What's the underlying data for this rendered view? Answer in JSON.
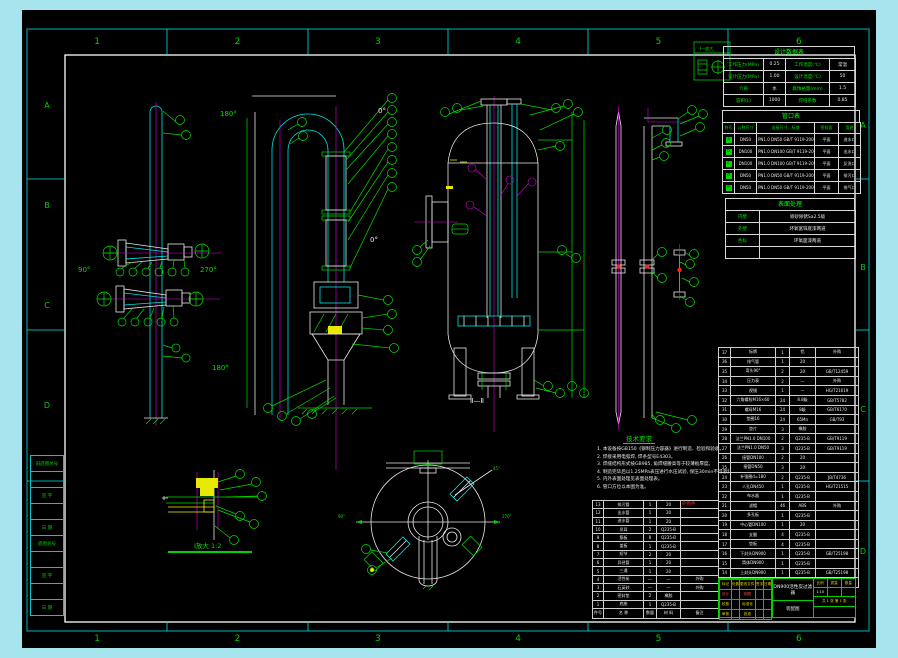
{
  "frame": {
    "zones_h": [
      "1",
      "2",
      "3",
      "4",
      "5",
      "6"
    ],
    "zones_v": [
      "A",
      "B",
      "C",
      "D"
    ]
  },
  "labels": {
    "v1_left": "90°",
    "v1_right": "270°",
    "v2_top": "180°",
    "v2_bottom": "180°",
    "v2_zero_top": "0°",
    "v2_zero_mid": "0°",
    "section": "Ⅱ—Ⅱ",
    "detail_caption": "Ⅰ放大 1:2",
    "legend_title": "Ⅰ—放大",
    "plan_45": "45°",
    "plan_left": "90°",
    "plan_right": "270°"
  },
  "design_table": {
    "title": "设计数据表",
    "rows": [
      [
        "工作压力(MPa)",
        "0.25",
        "工作温度(℃)",
        "常温"
      ],
      [
        "设计压力(MPa)",
        "1.00",
        "设计温度(℃)",
        "50"
      ],
      [
        "介质",
        "水",
        "腐蚀裕量(mm)",
        "1.5"
      ],
      [
        "容积(L)",
        "1000",
        "焊缝系数",
        "0.85"
      ]
    ]
  },
  "nozzle_table": {
    "title": "管口表",
    "header": [
      "符号",
      "公称尺寸",
      "连接尺寸、标准",
      "密封面",
      "用途"
    ],
    "rows": [
      [
        "a",
        "DN50",
        "PN1.0 DN50 GB/T 9119-2000",
        "平面",
        "进水口"
      ],
      [
        "b",
        "DN100",
        "PN1.0 DN100 GB/T 9119-2000",
        "平面",
        "出水口"
      ],
      [
        "c",
        "DN100",
        "PN1.0 DN100 GB/T 9119-2000",
        "平面",
        "反洗口"
      ],
      [
        "d",
        "DN50",
        "PN1.0 DN50 GB/T 9119-2000",
        "平面",
        "排污口"
      ],
      [
        "e",
        "DN50",
        "PN1.0 DN50 GB/T 9119-2000",
        "平面",
        "排气口"
      ]
    ]
  },
  "surface_table": {
    "title": "表面处理",
    "rows": [
      [
        "内壁",
        "喷砂除锈Sa2.5级"
      ],
      [
        "外壁",
        "环氧富锌底漆两道"
      ],
      [
        "色标",
        "环氧面漆两道"
      ],
      [
        "",
        ""
      ]
    ]
  },
  "notes": {
    "title": "技术要求",
    "lines": [
      "1. 本设备按GB150《钢制压力容器》进行制造、检验和验收。",
      "2. 焊接采用电弧焊, 焊条型号E4303。",
      "3. 焊缝结构形式按GB985, 角焊缝腰高等于较薄板厚度。",
      "4. 制造完毕后以1.25MPa表压进行水压试验, 保压30min不得渗漏。",
      "5. 内外表面处理见表面处理表。",
      "6. 管口方位以本图为准。"
    ]
  },
  "bom_right": {
    "header": [
      "件号",
      "名  称",
      "数量",
      "材 料",
      "备  注"
    ],
    "rows": [
      [
        "37",
        "标牌",
        "1",
        "铝",
        "外购"
      ],
      [
        "36",
        "排气管",
        "1",
        "20",
        ""
      ],
      [
        "35",
        "弯头90°",
        "2",
        "20",
        "GB/T12459"
      ],
      [
        "34",
        "压力表",
        "2",
        "—",
        "外购"
      ],
      [
        "33",
        "视镜",
        "1",
        "—",
        "HG/T21619"
      ],
      [
        "32",
        "六角螺栓M16×60",
        "24",
        "8.8级",
        "GB/T5782"
      ],
      [
        "31",
        "螺母M16",
        "24",
        "8级",
        "GB/T6170"
      ],
      [
        "30",
        "垫圈16",
        "24",
        "65Mn",
        "GB/T93"
      ],
      [
        "29",
        "垫片",
        "3",
        "橡胶",
        ""
      ],
      [
        "28",
        "法兰PN1.0 DN100",
        "2",
        "Q235-B",
        "GB/T9119"
      ],
      [
        "27",
        "法兰PN1.0 DN50",
        "3",
        "Q235-B",
        "GB/T9119"
      ],
      [
        "26",
        "接管DN100",
        "2",
        "20",
        ""
      ],
      [
        "25",
        "接管DN50",
        "3",
        "20",
        ""
      ],
      [
        "24",
        "补强圈d=180",
        "2",
        "Q235-B",
        "JB/T4736"
      ],
      [
        "23",
        "人孔DN450",
        "1",
        "Q235-B",
        "HG/T21515"
      ],
      [
        "22",
        "布水器",
        "1",
        "Q235-B",
        ""
      ],
      [
        "21",
        "滤帽",
        "46",
        "ABS",
        "外购"
      ],
      [
        "20",
        "多孔板",
        "1",
        "Q235-B",
        ""
      ],
      [
        "19",
        "中心管DN100",
        "1",
        "20",
        ""
      ],
      [
        "18",
        "支腿",
        "4",
        "Q235-B",
        ""
      ],
      [
        "17",
        "垫板",
        "4",
        "Q235-B",
        ""
      ],
      [
        "16",
        "下封头DN900",
        "1",
        "Q235-B",
        "GB/T25198"
      ],
      [
        "15",
        "筒体DN900",
        "1",
        "Q235-B",
        ""
      ],
      [
        "14",
        "上封头DN900",
        "1",
        "Q235-B",
        "GB/T25198"
      ]
    ]
  },
  "bom_bottom": {
    "red_note": "外购件",
    "header": [
      "件号",
      "名  称",
      "数量",
      "材 料",
      "备注"
    ],
    "rows": [
      [
        "13",
        "排污管",
        "1",
        "20",
        ""
      ],
      [
        "12",
        "出水管",
        "1",
        "20",
        ""
      ],
      [
        "11",
        "进水管",
        "1",
        "20",
        ""
      ],
      [
        "10",
        "吊耳",
        "2",
        "Q235-B",
        ""
      ],
      [
        "9",
        "筋板",
        "8",
        "Q235-B",
        ""
      ],
      [
        "8",
        "盖板",
        "1",
        "Q235-B",
        ""
      ],
      [
        "7",
        "短节",
        "2",
        "20",
        ""
      ],
      [
        "6",
        "异径管",
        "1",
        "20",
        ""
      ],
      [
        "5",
        "三通",
        "1",
        "20",
        ""
      ],
      [
        "4",
        "活性炭",
        "—",
        "—",
        "外购"
      ],
      [
        "3",
        "石英砂",
        "—",
        "—",
        "外购"
      ],
      [
        "2",
        "密封垫",
        "2",
        "橡胶",
        ""
      ],
      [
        "1",
        "底座",
        "1",
        "Q235-B",
        ""
      ]
    ]
  },
  "title_block": {
    "name": "DN900活性炭过滤器",
    "type_label": "装配图",
    "left_rows": [
      [
        "标记",
        "处数",
        "更改文件号",
        "签字",
        "日期"
      ],
      [
        "设计",
        "",
        "制图",
        "",
        ""
      ],
      [
        "校核",
        "",
        "标准化",
        "",
        ""
      ],
      [
        "审核",
        "",
        "批准",
        "",
        ""
      ]
    ],
    "right_labels": [
      "比例",
      "质量",
      "数量"
    ],
    "right_values": [
      "1:10",
      "",
      ""
    ],
    "sheet": "共 1 张  第 1 张"
  },
  "side_strip": {
    "rows": [
      "旧底图总号",
      "",
      "签 字",
      "",
      "日 期",
      "底图总号",
      "",
      "签 字",
      "",
      "日 期"
    ]
  },
  "colors": {
    "line_green": "#00e000",
    "line_cyan": "#00e5e5",
    "line_white": "#e8e8e8",
    "line_magenta": "#e000e0",
    "line_yellow": "#f0f000",
    "accent_red": "#ff3030",
    "margin_cyan": "#a6e4ee",
    "paper_black": "#000000"
  }
}
